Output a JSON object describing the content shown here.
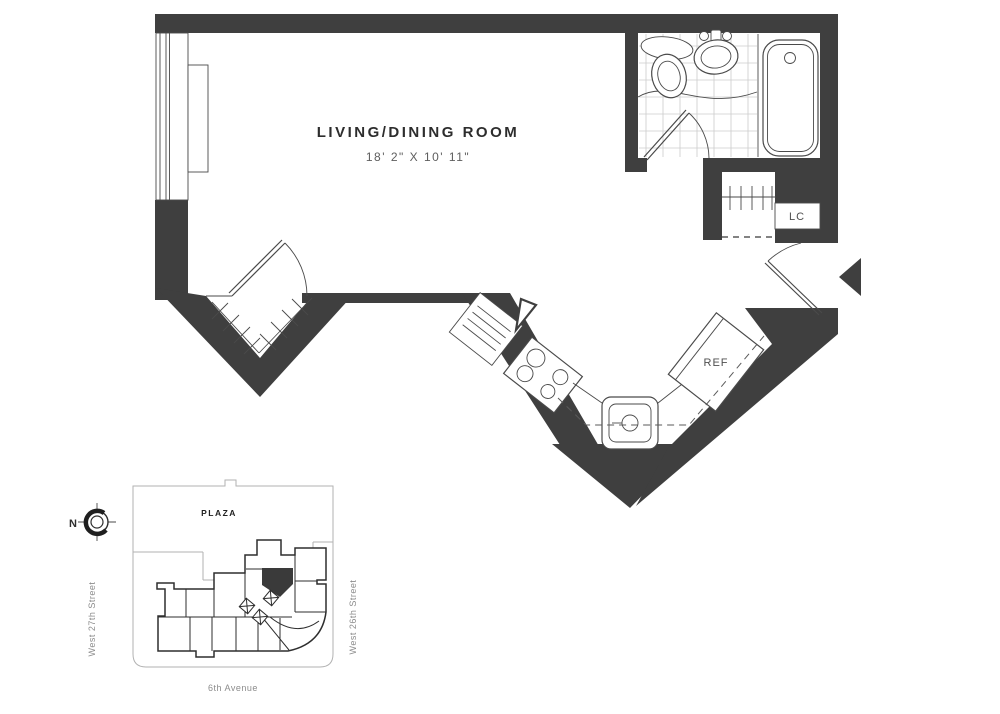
{
  "floorplan": {
    "room_label": "LIVING/DINING ROOM",
    "room_dimensions": "18' 2\" X 10' 11\"",
    "closet_label": "LC",
    "refrigerator_label": "REF"
  },
  "sitemap": {
    "plaza_label": "PLAZA",
    "street_left": "West 27th Street",
    "street_right": "West 26th Street",
    "avenue_bottom": "6th Avenue",
    "compass_north": "N"
  },
  "colors": {
    "wall": "#3f3f3f",
    "fixture_line": "#4a4a4a",
    "tile_line": "#cccccc",
    "dimension_text": "#5e5e5e",
    "map_building": "#2e2e2e",
    "map_outline": "#b2b2b2",
    "street_text": "#8c8c8c"
  }
}
